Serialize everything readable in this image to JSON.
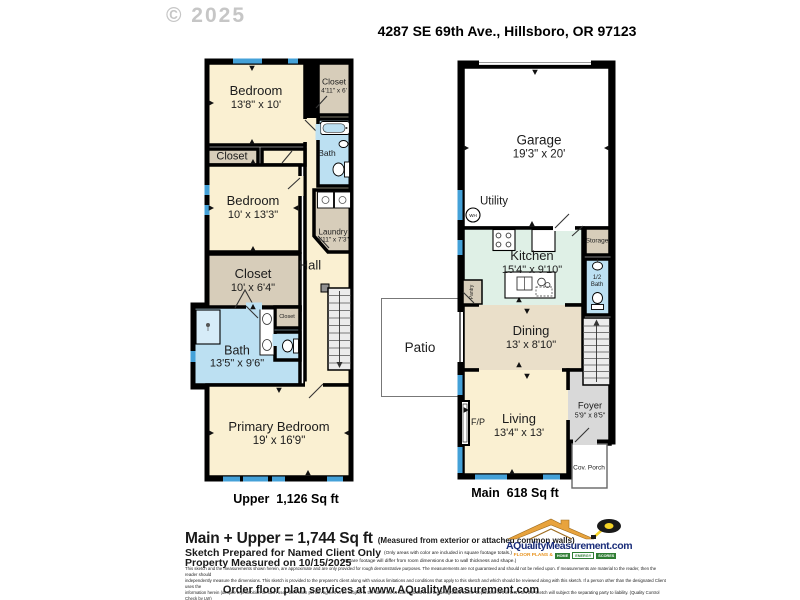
{
  "header": {
    "copyright": "© 2025",
    "address": "4287 SE 69th Ave., Hillsboro, OR 97123"
  },
  "upper": {
    "caption": "Upper  1,126 Sq ft",
    "rooms": {
      "bedroom1": {
        "name": "Bedroom",
        "dims": "13'8\" x 10'"
      },
      "closet_top": {
        "name": "Closet",
        "dims": "4'11\" x 6'"
      },
      "bath_top": {
        "name": "Bath"
      },
      "closet_strip": {
        "name": "Closet"
      },
      "bedroom2": {
        "name": "Bedroom",
        "dims": "10' x 13'3\""
      },
      "laundry": {
        "name": "Laundry",
        "dims": "4'11\" x 7'3\""
      },
      "closet_mid": {
        "name": "Closet",
        "dims": "10' x 6'4\""
      },
      "hall": {
        "name": "Hall"
      },
      "stair_label": "DN",
      "bath_main": {
        "name": "Bath",
        "dims": "13'5\" x 9'6\""
      },
      "closet_small": {
        "name": "Closet"
      },
      "primary": {
        "name": "Primary Bedroom",
        "dims": "19' x 16'9\""
      }
    }
  },
  "main": {
    "caption": "Main  618 Sq ft",
    "rooms": {
      "garage": {
        "name": "Garage",
        "dims": "19'3\" x 20'"
      },
      "utility": {
        "name": "Utility",
        "wh": "WH"
      },
      "kitchen": {
        "name": "Kitchen",
        "dims": "15'4\" x 9'10\""
      },
      "pantry": {
        "name": "Pantry"
      },
      "storage": {
        "name": "Storage"
      },
      "half_bath": {
        "name": "1/2 Bath"
      },
      "dining": {
        "name": "Dining",
        "dims": "13' x 8'10\""
      },
      "living": {
        "name": "Living",
        "dims": "13'4\" x 13'"
      },
      "fireplace": {
        "name": "F/P"
      },
      "foyer": {
        "name": "Foyer",
        "dims": "5'9\" x 8'5\""
      },
      "stair_label": "UP",
      "patio": {
        "name": "Patio"
      },
      "porch": {
        "name": "Cov. Porch"
      }
    }
  },
  "footer": {
    "total": "Main + Upper = 1,744 Sq ft",
    "total_note": "(Measured from exterior or attached common walls)",
    "prepared": "Sketch Prepared for Named Client Only",
    "measured": "Property Measured on 10/15/2025",
    "note1": "(Only areas with color are included in square footage totals.)",
    "note2": "(Square footage will differ from room dimensions due to wall thickness and shape.)",
    "disclaimer1": "This sketch and the measurements shown herein, are approximate and are only provided for rough demonstrative purposes.  The measurements are not guaranteed and should not be relied upon.  If measurements are material to the reader, then the reader should",
    "disclaimer2": "independently measure the dimensions.  This sketch is provided to the preparer's client along with various limitations and conditions that apply to this sketch and which should be reviewed along with this sketch.  If a person other than the designated Client uses the",
    "disclaimer3": "information herein (despite a prohibition on such use), then such person agrees to be subject to the same terms and limitations as the designated Client.  Separation of this text from the sketch will subject the separating party to liability.  (Quality Control Check by LW)",
    "order_line": "Order floor plan services at www.AQualityMeasurement.com",
    "logo": {
      "site": "AQualityMeasurement.com",
      "tag_left": "FLOOR PLANS &",
      "tag_home": "HOME",
      "tag_energy": "ENERGY",
      "tag_scores": "SCORES"
    }
  },
  "colors": {
    "wall": "#000000",
    "window": "#44A1D8",
    "room_cream": "#FAF0D2",
    "closet_beige": "#D7CDBA",
    "dining_tan": "#EADFC9",
    "bath_blue": "#BCE0F2",
    "kitchen_green": "#DFF0E6",
    "foyer_gray": "#D9D9D9",
    "stairs_gray": "#ECECEC",
    "logo_navy": "#1A2D7A",
    "logo_orange": "#E8921C",
    "logo_green": "#2F7D33"
  }
}
